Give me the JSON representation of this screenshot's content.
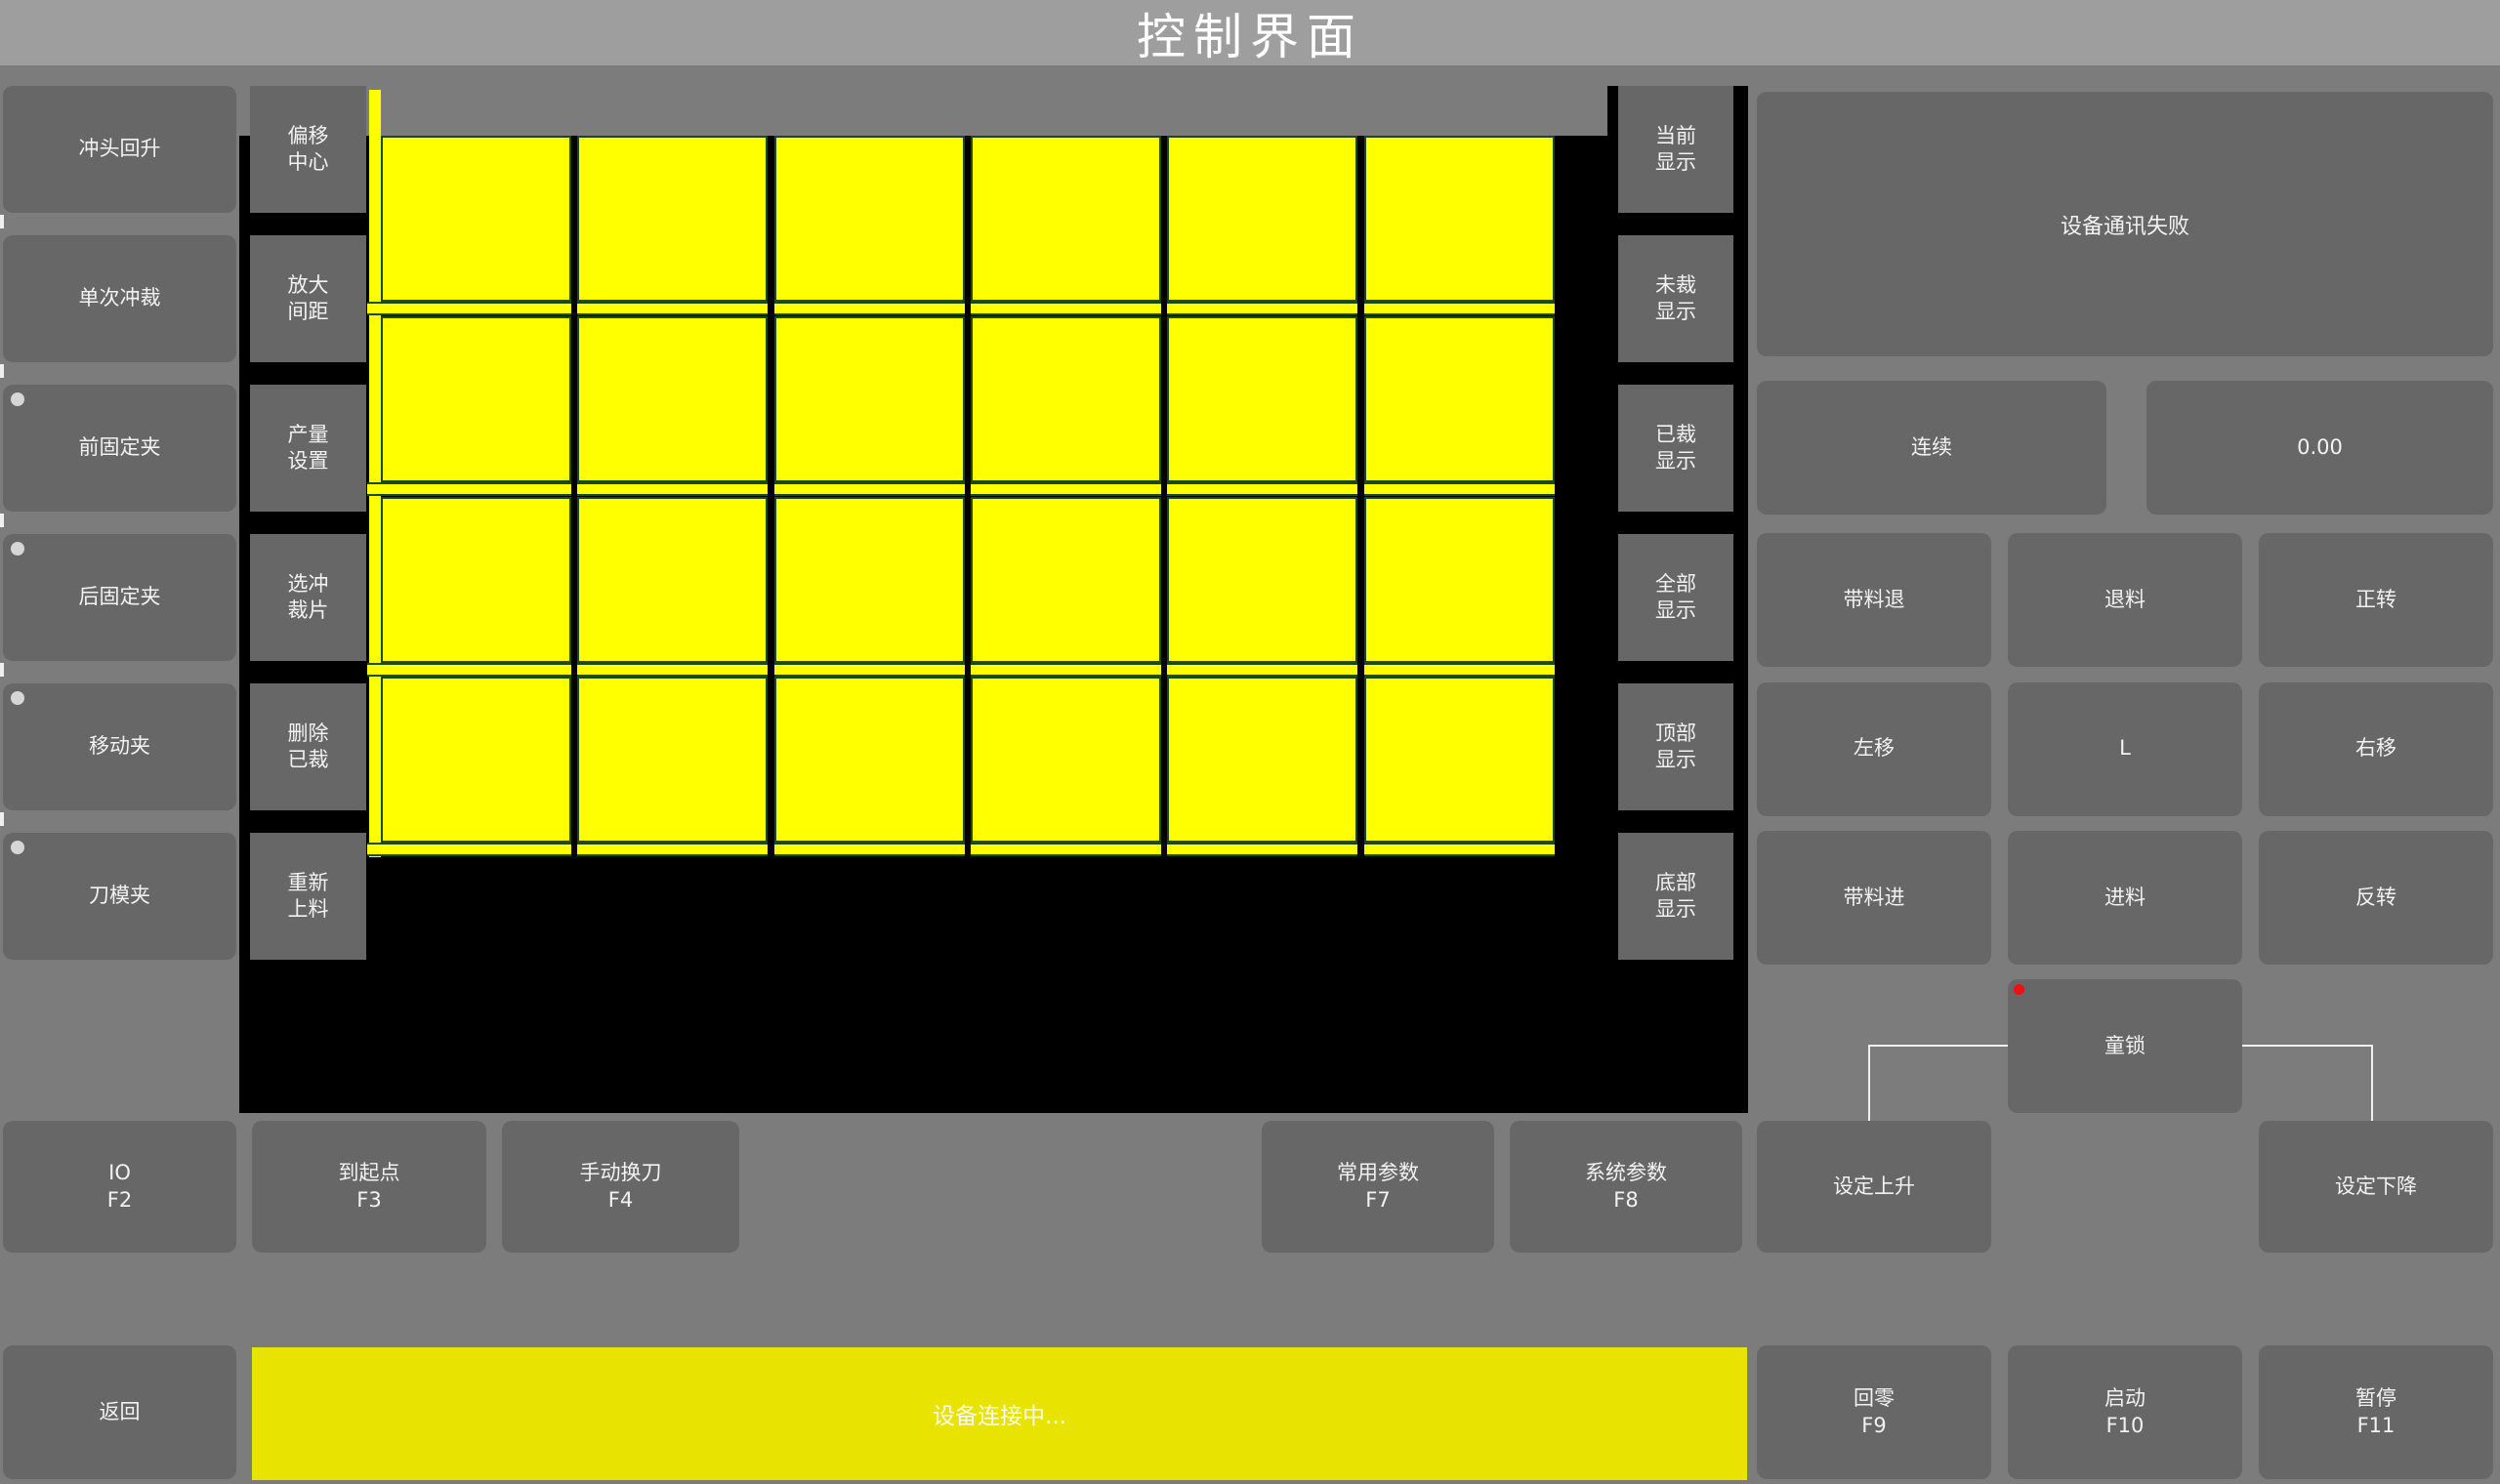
{
  "title": "控制界面",
  "colors": {
    "background": "#7c7c7c",
    "titlebar": "#9e9e9e",
    "button": "#676767",
    "canvas_black": "#000000",
    "piece_yellow": "#ffff00",
    "piece_border_green": "#1c4a14",
    "statusbar_yellow": "#e8e300",
    "alarm_red": "#ee1111",
    "connector_white": "#efefef",
    "indicator_dot": "#d6d6d6"
  },
  "left_buttons": [
    {
      "label": "冲头回升",
      "dot": false
    },
    {
      "label": "单次冲裁",
      "dot": false
    },
    {
      "label": "前固定夹",
      "dot": true
    },
    {
      "label": "后固定夹",
      "dot": true
    },
    {
      "label": "移动夹",
      "dot": true
    },
    {
      "label": "刀模夹",
      "dot": true
    }
  ],
  "tool_buttons": [
    {
      "l1": "偏移",
      "l2": "中心"
    },
    {
      "l1": "放大",
      "l2": "间距"
    },
    {
      "l1": "产量",
      "l2": "设置"
    },
    {
      "l1": "选冲",
      "l2": "裁片"
    },
    {
      "l1": "删除",
      "l2": "已裁"
    },
    {
      "l1": "重新",
      "l2": "上料"
    }
  ],
  "display_buttons": [
    {
      "l1": "当前",
      "l2": "显示"
    },
    {
      "l1": "未裁",
      "l2": "显示"
    },
    {
      "l1": "已裁",
      "l2": "显示"
    },
    {
      "l1": "全部",
      "l2": "显示"
    },
    {
      "l1": "顶部",
      "l2": "显示"
    },
    {
      "l1": "底部",
      "l2": "显示"
    }
  ],
  "piece_grid": {
    "rows": 4,
    "cols": 6
  },
  "right_panel": {
    "status_box": "设备通讯失败",
    "mode_button": "连续",
    "value_display": "0.00",
    "jog_buttons": [
      "带料退",
      "退料",
      "正转",
      "左移",
      "L",
      "右移",
      "带料进",
      "进料",
      "反转"
    ],
    "child_lock": "童锁"
  },
  "fkey_buttons": [
    {
      "label": "IO",
      "key": "F2"
    },
    {
      "label": "到起点",
      "key": "F3"
    },
    {
      "label": "手动换刀",
      "key": "F4"
    },
    {
      "label": "常用参数",
      "key": "F7"
    },
    {
      "label": "系统参数",
      "key": "F8"
    }
  ],
  "set_buttons": [
    "设定上升",
    "设定下降"
  ],
  "bottom_bar": {
    "back": "返回",
    "status": "设备连接中...",
    "keys": [
      {
        "label": "回零",
        "key": "F9"
      },
      {
        "label": "启动",
        "key": "F10"
      },
      {
        "label": "暂停",
        "key": "F11"
      }
    ]
  }
}
